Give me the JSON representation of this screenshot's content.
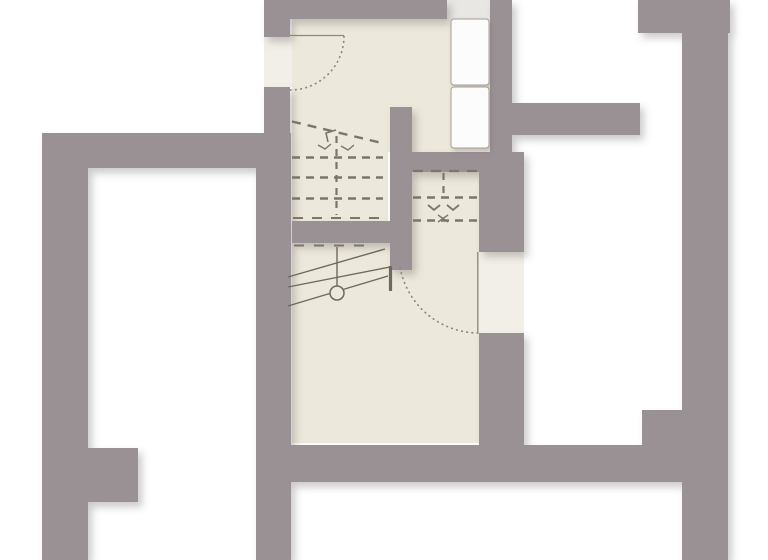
{
  "colors": {
    "background": "#ffffff",
    "wall": "#9a9195",
    "floor": "#ece8db",
    "opening": "#f1efe7",
    "window_light": "#e8e7e4",
    "furniture": "#fcfcfc",
    "furniture_stroke": "#a59d94",
    "line_solid": "#6e685e",
    "line_dash": "#7b756b",
    "door_line": "#8e8679",
    "shadow": "#6f6568"
  },
  "plan": {
    "width": 768,
    "height": 560,
    "layers": [
      {
        "name": "floors",
        "shadow": null,
        "shapes": [
          {
            "kind": "rect",
            "name": "floor-upper-room",
            "x": 292,
            "y": 19,
            "w": 198,
            "h": 133,
            "fill": "floor"
          },
          {
            "kind": "rect",
            "name": "floor-stair-landing",
            "x": 292,
            "y": 152,
            "w": 96,
            "h": 69,
            "fill": "floor"
          },
          {
            "kind": "rect",
            "name": "floor-right-stair-room",
            "x": 407,
            "y": 172,
            "w": 72,
            "h": 71,
            "fill": "floor"
          },
          {
            "kind": "rect",
            "name": "floor-lower-room",
            "x": 292,
            "y": 243,
            "w": 187,
            "h": 200,
            "fill": "floor"
          },
          {
            "kind": "rect",
            "name": "door-opening-top-left",
            "x": 264,
            "y": 37,
            "w": 28,
            "h": 50,
            "fill": "opening"
          },
          {
            "kind": "rect",
            "name": "door-opening-east",
            "x": 479,
            "y": 252,
            "w": 45,
            "h": 81,
            "fill": "opening"
          },
          {
            "kind": "rect",
            "name": "window-strip",
            "x": 447,
            "y": 0,
            "w": 43,
            "h": 19,
            "fill": "window_light"
          }
        ]
      },
      {
        "name": "walls",
        "shadow": "wallShadow",
        "shapes": [
          {
            "kind": "rect",
            "name": "wall-top",
            "x": 264,
            "y": 0,
            "w": 183,
            "h": 19,
            "fill": "wall"
          },
          {
            "kind": "rect",
            "name": "wall-left-top-stub",
            "x": 264,
            "y": 0,
            "w": 26,
            "h": 37,
            "fill": "wall"
          },
          {
            "kind": "rect",
            "name": "wall-left-upper",
            "x": 264,
            "y": 87,
            "w": 26,
            "h": 46,
            "fill": "wall"
          },
          {
            "kind": "rect",
            "name": "wall-left-main",
            "x": 256,
            "y": 133,
            "w": 35,
            "h": 427,
            "fill": "wall"
          },
          {
            "kind": "rect",
            "name": "wall-west-bar",
            "x": 42,
            "y": 133,
            "w": 224,
            "h": 35,
            "fill": "wall"
          },
          {
            "kind": "rect",
            "name": "wall-west-outer",
            "x": 42,
            "y": 133,
            "w": 46,
            "h": 427,
            "fill": "wall"
          },
          {
            "kind": "rect",
            "name": "wall-west-stub",
            "x": 88,
            "y": 448,
            "w": 50,
            "h": 54,
            "fill": "wall"
          },
          {
            "kind": "rect",
            "name": "wall-inner-north",
            "x": 490,
            "y": 0,
            "w": 22,
            "h": 172,
            "fill": "wall"
          },
          {
            "kind": "rect",
            "name": "wall-north-east",
            "x": 510,
            "y": 103,
            "w": 130,
            "h": 32,
            "fill": "wall"
          },
          {
            "kind": "rect",
            "name": "wall-separator",
            "x": 398,
            "y": 152,
            "w": 126,
            "h": 20,
            "fill": "wall"
          },
          {
            "kind": "rect",
            "name": "wall-east-room-upper",
            "x": 479,
            "y": 152,
            "w": 45,
            "h": 100,
            "fill": "wall"
          },
          {
            "kind": "rect",
            "name": "wall-east-room-lower",
            "x": 479,
            "y": 333,
            "w": 45,
            "h": 112,
            "fill": "wall"
          },
          {
            "kind": "rect",
            "name": "wall-stair-stub",
            "x": 390,
            "y": 107,
            "w": 22,
            "h": 163,
            "fill": "wall"
          },
          {
            "kind": "rect",
            "name": "wall-mid-band",
            "x": 292,
            "y": 221,
            "w": 115,
            "h": 22,
            "fill": "wall"
          },
          {
            "kind": "rect",
            "name": "wall-south",
            "x": 291,
            "y": 445,
            "w": 393,
            "h": 37,
            "fill": "wall"
          },
          {
            "kind": "rect",
            "name": "wall-ne-block",
            "x": 638,
            "y": 0,
            "w": 92,
            "h": 33,
            "fill": "wall"
          },
          {
            "kind": "rect",
            "name": "wall-east-outer",
            "x": 682,
            "y": 0,
            "w": 46,
            "h": 560,
            "fill": "wall"
          },
          {
            "kind": "rect",
            "name": "wall-east-step",
            "x": 642,
            "y": 410,
            "w": 42,
            "h": 37,
            "fill": "wall"
          }
        ]
      },
      {
        "name": "fixtures",
        "shadow": "furnShadow",
        "shapes": [
          {
            "kind": "rect",
            "name": "cabinet-top",
            "x": 451,
            "y": 19,
            "w": 38,
            "h": 66,
            "rx": 3,
            "fill": "furniture",
            "stroke": "furniture_stroke",
            "sw": 1
          },
          {
            "kind": "rect",
            "name": "cabinet-bottom",
            "x": 451,
            "y": 87,
            "w": 38,
            "h": 61,
            "rx": 3,
            "fill": "furniture",
            "stroke": "furniture_stroke",
            "sw": 1
          }
        ]
      },
      {
        "name": "stair-marks",
        "shadow": null,
        "shapes": [
          {
            "kind": "line",
            "name": "stair-upper-diagonal",
            "x1": 292,
            "y1": 121.5,
            "x2": 384,
            "y2": 143.5,
            "stroke": "line_dash",
            "sw": 2.4,
            "dash": "9 7"
          },
          {
            "kind": "line",
            "name": "stair-upper-row-1",
            "x1": 292,
            "y1": 157.5,
            "x2": 383,
            "y2": 157.5,
            "stroke": "line_dash",
            "sw": 2.4,
            "dash": "8 6"
          },
          {
            "kind": "line",
            "name": "stair-upper-row-2",
            "x1": 292,
            "y1": 177.5,
            "x2": 383,
            "y2": 177.5,
            "stroke": "line_dash",
            "sw": 2.4,
            "dash": "8 6"
          },
          {
            "kind": "line",
            "name": "stair-upper-row-3",
            "x1": 292,
            "y1": 198.5,
            "x2": 383,
            "y2": 198.5,
            "stroke": "line_dash",
            "sw": 2.4,
            "dash": "8 6"
          },
          {
            "kind": "line",
            "name": "stair-upper-center",
            "x1": 336.5,
            "y1": 136,
            "x2": 336.5,
            "y2": 215,
            "stroke": "line_dash",
            "sw": 2.2,
            "dash": "7 6"
          },
          {
            "kind": "line",
            "name": "stair-upper-break",
            "x1": 293,
            "y1": 218,
            "x2": 380,
            "y2": 218,
            "stroke": "line_dash",
            "sw": 2,
            "dash": "10 9"
          },
          {
            "kind": "polyline",
            "name": "stair-upper-arrow",
            "points": "336,130 326,133 328,142",
            "stroke": "line_dash",
            "sw": 1.6
          },
          {
            "kind": "polyline",
            "name": "stair-upper-tick-1",
            "points": "318,145 325,149 331,144",
            "stroke": "line_dash",
            "sw": 1.4
          },
          {
            "kind": "polyline",
            "name": "stair-upper-tick-2",
            "points": "341,146 348,150 354,145",
            "stroke": "line_dash",
            "sw": 1.4
          },
          {
            "kind": "line",
            "name": "stair-right-edge",
            "x1": 413,
            "y1": 171,
            "x2": 478,
            "y2": 171,
            "stroke": "line_dash",
            "sw": 2.2,
            "dash": "10 8"
          },
          {
            "kind": "line",
            "name": "stair-right-center",
            "x1": 443.5,
            "y1": 173,
            "x2": 443.5,
            "y2": 197,
            "stroke": "line_dash",
            "sw": 2.2,
            "dash": "7 6"
          },
          {
            "kind": "line",
            "name": "stair-right-row-1",
            "x1": 413,
            "y1": 197.5,
            "x2": 478,
            "y2": 197.5,
            "stroke": "line_dash",
            "sw": 2.4,
            "dash": "8 6"
          },
          {
            "kind": "line",
            "name": "stair-right-row-2",
            "x1": 413,
            "y1": 220.5,
            "x2": 478,
            "y2": 220.5,
            "stroke": "line_dash",
            "sw": 2.4,
            "dash": "8 6"
          },
          {
            "kind": "polyline",
            "name": "stair-right-arrow-1",
            "points": "428,205 434,210 440,205",
            "stroke": "line_dash",
            "sw": 1.8
          },
          {
            "kind": "polyline",
            "name": "stair-right-arrow-2",
            "points": "447,205 453,210 459,205",
            "stroke": "line_dash",
            "sw": 1.8
          },
          {
            "kind": "line",
            "name": "stair-right-cross-a",
            "x1": 438,
            "y1": 215,
            "x2": 448,
            "y2": 222,
            "stroke": "line_dash",
            "sw": 1.4
          },
          {
            "kind": "line",
            "name": "stair-right-cross-b",
            "x1": 448,
            "y1": 215,
            "x2": 438,
            "y2": 222,
            "stroke": "line_dash",
            "sw": 1.4
          },
          {
            "kind": "line",
            "name": "stair-lower-break",
            "x1": 294,
            "y1": 245.5,
            "x2": 368,
            "y2": 245.5,
            "stroke": "line_dash",
            "sw": 2,
            "dash": "10 10"
          },
          {
            "kind": "line",
            "name": "stair-lower-rail-1",
            "x1": 288,
            "y1": 277,
            "x2": 385,
            "y2": 249,
            "stroke": "line_solid",
            "sw": 1.4
          },
          {
            "kind": "line",
            "name": "stair-lower-rail-2",
            "x1": 288,
            "y1": 287,
            "x2": 390,
            "y2": 267,
            "stroke": "line_solid",
            "sw": 1.4
          },
          {
            "kind": "line",
            "name": "stair-lower-rail-3",
            "x1": 288,
            "y1": 306,
            "x2": 388,
            "y2": 276,
            "stroke": "line_solid",
            "sw": 1.4
          },
          {
            "kind": "line",
            "name": "stair-lower-post-line",
            "x1": 337,
            "y1": 247,
            "x2": 337,
            "y2": 286,
            "stroke": "line_solid",
            "sw": 1.4
          },
          {
            "kind": "circle",
            "name": "stair-lower-newel",
            "cx": 337,
            "cy": 293,
            "r": 7,
            "fill": "floor",
            "stroke": "line_solid",
            "sw": 1.5
          },
          {
            "kind": "line",
            "name": "stair-lower-bar",
            "x1": 390.5,
            "y1": 266,
            "x2": 390.5,
            "y2": 291,
            "stroke": "line_solid",
            "sw": 3.2
          }
        ]
      },
      {
        "name": "doors",
        "shadow": null,
        "shapes": [
          {
            "kind": "line",
            "name": "door-top-left-leaf",
            "x1": 290,
            "y1": 35.5,
            "x2": 344,
            "y2": 35.5,
            "stroke": "door_line",
            "sw": 1.3
          },
          {
            "kind": "path",
            "name": "door-top-left-swing",
            "d": "M344,36.5 A54,54 0 0 1 290,90",
            "stroke": "door_line",
            "sw": 1.7,
            "dash": "0.6 4.6",
            "cap": "round"
          },
          {
            "kind": "line",
            "name": "door-east-leaf",
            "x1": 477.8,
            "y1": 252,
            "x2": 477.8,
            "y2": 333,
            "stroke": "door_line",
            "sw": 1.3
          },
          {
            "kind": "path",
            "name": "door-east-swing",
            "d": "M477.8,333 A80,80 0 0 1 400,267",
            "stroke": "door_line",
            "sw": 1.7,
            "dash": "0.6 4.6",
            "cap": "round"
          }
        ]
      }
    ]
  }
}
